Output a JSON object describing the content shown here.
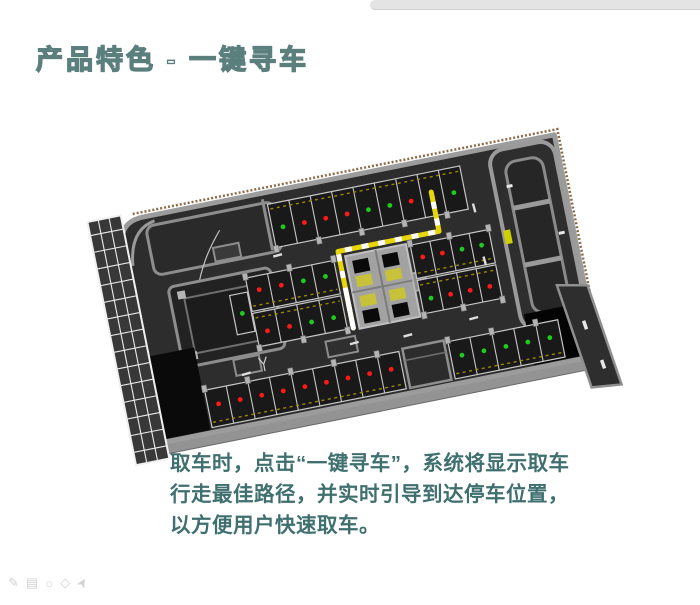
{
  "slide": {
    "title": "产品特色 - 一键寻车",
    "body_lines": [
      "取车时，点击“一键寻车”，系统将显示取车",
      "行走最佳路径，并实时引导到达停车位置，",
      "以方便用户快速取车。"
    ],
    "title_color": "#5a7f7d",
    "body_color": "#3f6f6f"
  },
  "footer_tools": [
    {
      "name": "pencil-icon",
      "glyph": "✎"
    },
    {
      "name": "image-icon",
      "glyph": "▤"
    },
    {
      "name": "ellipse-icon",
      "glyph": "○"
    },
    {
      "name": "shape-icon",
      "glyph": "◇"
    },
    {
      "name": "cursor-icon",
      "glyph": "➤"
    }
  ],
  "garage": {
    "legend": {
      "occupied": "red dot",
      "vacant": "green dot"
    },
    "colors": {
      "floor": "#2d2d2d",
      "wall": "#9c9c9c",
      "space_fill": "#191919",
      "space_line": "#c6c6c6",
      "pillar": "#b4b4b4",
      "occupied": "#ff1a1a",
      "vacant": "#1ecc1e",
      "guide_path": "#e8d60a",
      "tick": "#a38d00",
      "slab": "#939393",
      "rim": "#8a6b46"
    },
    "rows": [
      {
        "id": "top-row",
        "x": 150,
        "y": 12,
        "w": 196,
        "h": 44,
        "dots": [
          "g",
          "r",
          "r",
          "r",
          "g",
          "g",
          "r",
          "r",
          "g"
        ],
        "ticks": "top",
        "pillars": "bottom",
        "dest_index": 7
      },
      {
        "id": "mid-left-end-space",
        "x": 95,
        "y": 94,
        "w": 18,
        "h": 40,
        "dots": [
          "g"
        ],
        "ticks": null,
        "pillars": null
      },
      {
        "id": "mid-left-upper",
        "x": 114,
        "y": 80,
        "w": 90,
        "h": 34,
        "dots": [
          "r",
          "r",
          "g",
          "g"
        ],
        "ticks": "bottom",
        "pillars": "top"
      },
      {
        "id": "mid-left-lower",
        "x": 114,
        "y": 116,
        "w": 90,
        "h": 34,
        "dots": [
          "r",
          "r",
          "g",
          "g"
        ],
        "ticks": "top",
        "pillars": "bottom"
      },
      {
        "id": "mid-right-upper",
        "x": 282,
        "y": 80,
        "w": 80,
        "h": 34,
        "dots": [
          "r",
          "r",
          "g",
          "g"
        ],
        "ticks": "bottom",
        "pillars": "top"
      },
      {
        "id": "mid-right-lower",
        "x": 282,
        "y": 116,
        "w": 80,
        "h": 34,
        "dots": [
          "g",
          "r",
          "r",
          "r"
        ],
        "ticks": "top",
        "pillars": "bottom"
      },
      {
        "id": "bottom-row-left",
        "x": 52,
        "y": 182,
        "w": 198,
        "h": 38,
        "dots": [
          "r",
          "r",
          "r",
          "r",
          "r",
          "r",
          "r",
          "r",
          "r"
        ],
        "ticks": "bottom",
        "pillars": "top"
      },
      {
        "id": "bottom-row-right",
        "x": 300,
        "y": 182,
        "w": 112,
        "h": 38,
        "dots": [
          "g",
          "g",
          "g",
          "g",
          "g"
        ],
        "ticks": "bottom",
        "pillars": "top"
      }
    ],
    "guide_path": {
      "points": [
        [
          210,
          150
        ],
        [
          210,
          72
        ],
        [
          313,
          72
        ],
        [
          313,
          32
        ]
      ],
      "start_white_frac": 0.45
    },
    "road_marks": [
      {
        "x": 150,
        "y": 64,
        "r": -4
      },
      {
        "x": 208,
        "y": 165,
        "r": -4
      },
      {
        "x": 262,
        "y": 168,
        "r": -4
      },
      {
        "x": 330,
        "y": 164,
        "r": -4
      },
      {
        "x": 96,
        "y": 174,
        "r": -6
      },
      {
        "x": 352,
        "y": 110,
        "r": 86
      },
      {
        "x": 352,
        "y": 56,
        "r": 86
      }
    ]
  }
}
